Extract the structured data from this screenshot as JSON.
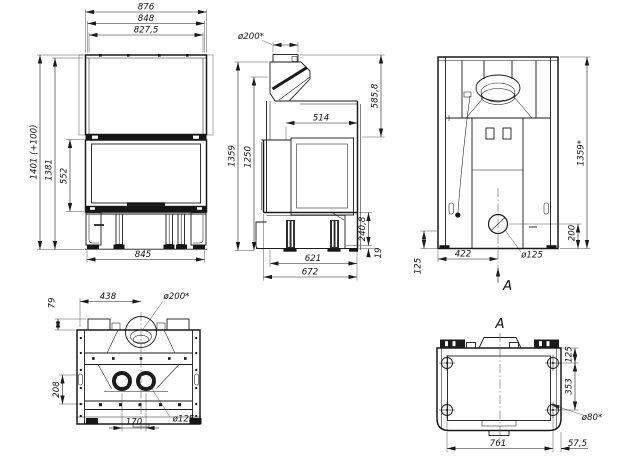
{
  "views": {
    "front": {
      "dims": {
        "width_total": "876",
        "width_frame": "848",
        "width_opening": "827,5",
        "height_total": "1401 (+100)",
        "height_body": "1381",
        "height_glass": "552",
        "width_base": "845"
      }
    },
    "side": {
      "dims": {
        "flue_dia": "ø200*",
        "hood_height": "585,8",
        "depth_top": "514",
        "height_total": "1359",
        "height_body": "1250",
        "base_height": "240,8",
        "foot_height": "19",
        "depth_inner": "621",
        "depth_total": "672"
      }
    },
    "back": {
      "section_mark": "A",
      "dims": {
        "height_total": "1359*",
        "outlet_height": "200",
        "plinth_height": "125",
        "outlet_offset": "422",
        "outlet_dia": "ø125"
      }
    },
    "plan": {
      "dims": {
        "rim_offset": "79",
        "flue_offset": "438",
        "flue_dia": "ø200*",
        "rear_depth": "208",
        "duct_spacing": "170",
        "duct_dia": "ø125"
      }
    },
    "section": {
      "label": "A",
      "dims": {
        "foot_top_offset": "125",
        "foot_row_spacing": "353",
        "foot_dia": "ø80*",
        "foot_col_spacing": "761",
        "foot_side_offset": "57,5"
      }
    }
  }
}
